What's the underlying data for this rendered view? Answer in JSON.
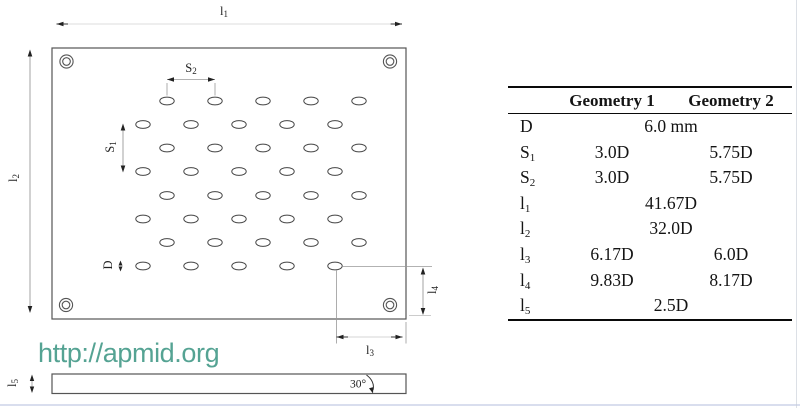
{
  "figure": {
    "description": "perforated-plate geometry drawing with dimension table",
    "line_color": "#555555",
    "dimension_color": "#999999"
  },
  "diagram": {
    "labels": {
      "l1": {
        "base": "l",
        "sub": "1"
      },
      "l2": {
        "base": "l",
        "sub": "2"
      },
      "l3": {
        "base": "l",
        "sub": "3"
      },
      "l4": {
        "base": "l",
        "sub": "4"
      },
      "l5": {
        "base": "l",
        "sub": "5"
      },
      "s1": {
        "base": "S",
        "sub": "1"
      },
      "s2": {
        "base": "S",
        "sub": "2"
      },
      "d": {
        "base": "D",
        "sub": ""
      },
      "angle": "30°"
    }
  },
  "watermark": {
    "text": "http://apmid.org",
    "color": "#55A393"
  },
  "table": {
    "headers": [
      {
        "label": "Geometry 1"
      },
      {
        "label": "Geometry 2"
      }
    ],
    "rows": [
      {
        "base": "D",
        "sub": "",
        "span": "6.0 mm"
      },
      {
        "base": "S",
        "sub": "1",
        "g1": "3.0D",
        "g2": "5.75D"
      },
      {
        "base": "S",
        "sub": "2",
        "g1": "3.0D",
        "g2": "5.75D"
      },
      {
        "base": "l",
        "sub": "1",
        "span": "41.67D"
      },
      {
        "base": "l",
        "sub": "2",
        "span": "32.0D"
      },
      {
        "base": "l",
        "sub": "3",
        "g1": "6.17D",
        "g2": "6.0D"
      },
      {
        "base": "l",
        "sub": "4",
        "g1": "9.83D",
        "g2": "8.17D"
      },
      {
        "base": "l",
        "sub": "5",
        "span": "2.5D"
      }
    ]
  }
}
